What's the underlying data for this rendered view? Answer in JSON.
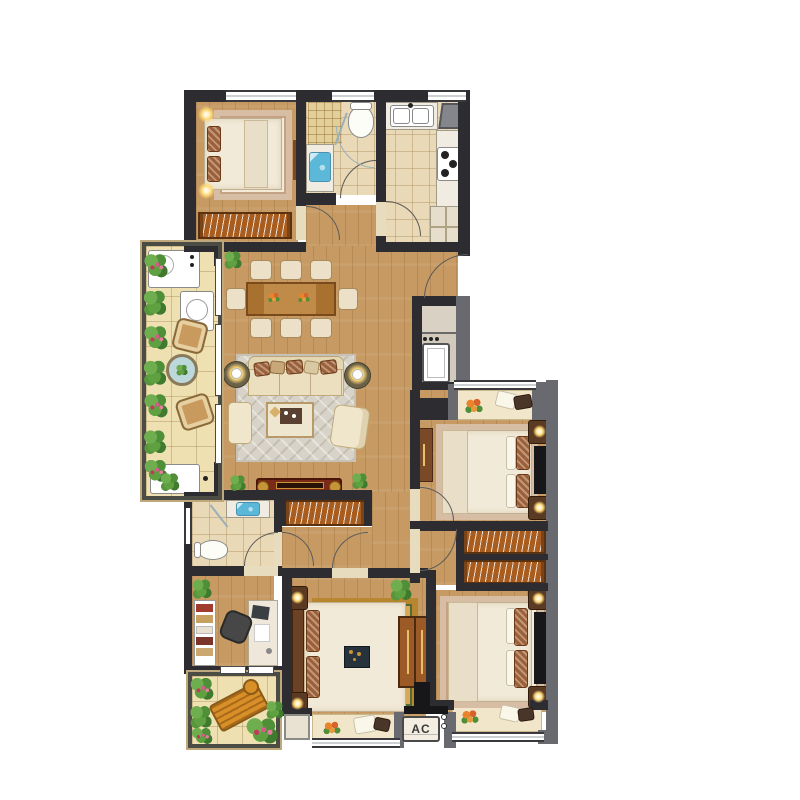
{
  "labels": {
    "ac": "AC"
  },
  "palette": {
    "wall_dark": "#2d2d31",
    "wall_gray": "#696a6f",
    "wood": "#c69a62",
    "tile": "#ead9b6",
    "balcony_tile": "#eee0b0",
    "sill": "#f2e6ca",
    "rug": "#d8d3c8",
    "rug_border": "#d6bda4",
    "wardrobe": "#a85c1e",
    "linen": "#f2ead8",
    "sofa": "#ecdfc0",
    "dining_table": "#a9712f",
    "console": "#7a2a16",
    "gold": "#c89438",
    "water": "#5cb8d8",
    "plant": "#4e8f38",
    "glow": "#ffd978",
    "door": "#5a5a5a",
    "glass": "#9ab0b8",
    "master_rug": "#b8862e",
    "master_rug_center": "#d9a855",
    "lounge": "#d88f28",
    "counter": "#f0ece2",
    "niche": "#d2cabc"
  }
}
